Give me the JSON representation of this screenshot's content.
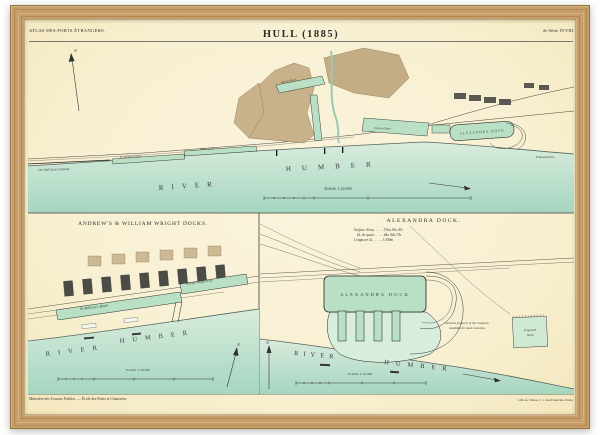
{
  "colors": {
    "paper": "#f8f0d2",
    "water_top": "#dcefe2",
    "water_bottom": "#a5d6bf",
    "dock_green": "#b9e0c4",
    "town_tan": "#c9b28b",
    "frame_wood": "#c89e68"
  },
  "plate": {
    "header": {
      "series": "ATLAS DES PORTS ÉTRANGERS.",
      "title": "HULL (1885)",
      "plate_no": "2e Série. Pl.VIII"
    },
    "main": {
      "north": "N.",
      "river1": "RIVER",
      "river2": "HUMBER",
      "scale": "Echelle 1:20.000",
      "labels": {
        "hull_dock_co": "The Hull Dock Company",
        "st_andrews": "St Andrew's Dock",
        "albert": "Albert Dock",
        "queens": "Queen's Dock",
        "victoria": "Victoria Dock",
        "alexandra": "ALEXANDRA DOCK",
        "proposed": "Proposed Dock"
      }
    },
    "left_inset": {
      "title": "ANDREW'S & WILLIAM WRIGHT DOCKS.",
      "st_andrews": "St Andrew's Dock",
      "william_wright": "William Wright Dock",
      "river1": "RIVER",
      "river2": "HUMBER",
      "scale": "Echelle 1:10.000",
      "north": "N."
    },
    "right_inset": {
      "title": "ALEXANDRA DOCK.",
      "stats1": "Surface d'eau . . . . . 33ha 30a 43c",
      "stats2": "Id.  de quais . . . . . 4ha 44a 74c",
      "stats3": "Longueur id. . . . . . 3.300m",
      "dock": "ALEXANDRA DOCK",
      "note1": "Land the property of the Company",
      "note2": "available for dock extension.",
      "proposed1": "Proposed",
      "proposed2": "Dock",
      "river1": "RIVER",
      "river2": "HUMBER",
      "scale": "Echelle 1:10.000",
      "north": "N."
    },
    "footer": {
      "left": "Ministère des Travaux Publics. — École des Ponts et Chaussées.",
      "right": "Lith. A. Simon, 1. r. des Poitevins, Paris."
    }
  }
}
